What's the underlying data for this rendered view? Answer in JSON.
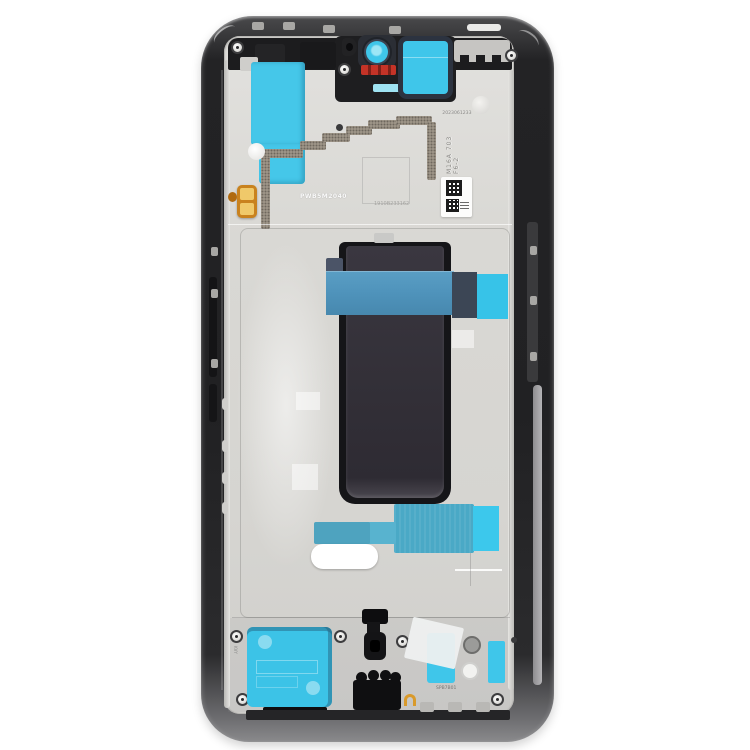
{
  "labels": {
    "batch_code": "2023061233",
    "stamp_code": "M16A 703 F6-2",
    "board_code": "PWB5M2040",
    "serial_code": "1910B233162",
    "bottom_code": "SPB7B01",
    "side_code": "KVY"
  },
  "colors": {
    "background": "#ffffff",
    "frame_black": "#232325",
    "plate_silver": "#d9d8d4",
    "adhesive_cyan": "#3fc6ea",
    "tape_blue": "#4f93bb",
    "tape_teal": "#4aa9c6",
    "tape_navy": "#3c4655",
    "camera_red": "#c43327",
    "contact_gold": "#d99a2b",
    "display_charcoal": "#34313a",
    "emi_shield_gray": "#a59c8f",
    "pad_white": "#ffffff"
  }
}
